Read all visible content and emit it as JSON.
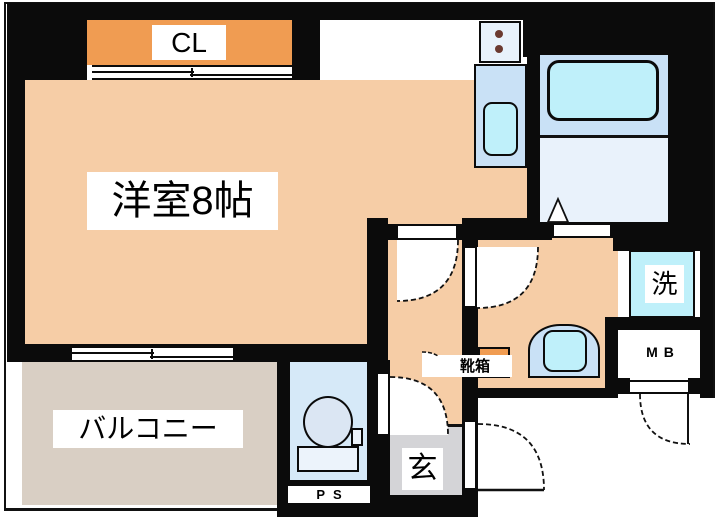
{
  "title": "1R apartment floor plan",
  "labels": {
    "main_room": "洋室8帖",
    "closet": "CL",
    "balcony": "バルコニー",
    "entrance": "玄",
    "laundry": "洗",
    "shoe_box": "靴箱",
    "pipe_space": "PS",
    "meter_box": "MB"
  },
  "fixtures": [
    "two-burner-stove",
    "kitchen-sink",
    "bathtub",
    "bath-door",
    "washing-machine-space",
    "wash-basin",
    "toilet",
    "shoe-box",
    "closet-sliding-door",
    "balcony-sliding-window",
    "entrance-door",
    "meter-box-door",
    "room-hinged-door",
    "hall-hinged-door",
    "toilet-hinged-door"
  ],
  "colors": {
    "wall": "#0b0b0b",
    "room_floor": "#f6cda6",
    "closet": "#f09c52",
    "fixture_panel": "#c9e1f6",
    "water_cyan": "#bff0fa",
    "bath_floor": "#e9f2fb",
    "toilet_floor": "#d6e9f8",
    "balcony_floor": "#d9cfc4",
    "entrance_floor": "#d4d4d7"
  }
}
